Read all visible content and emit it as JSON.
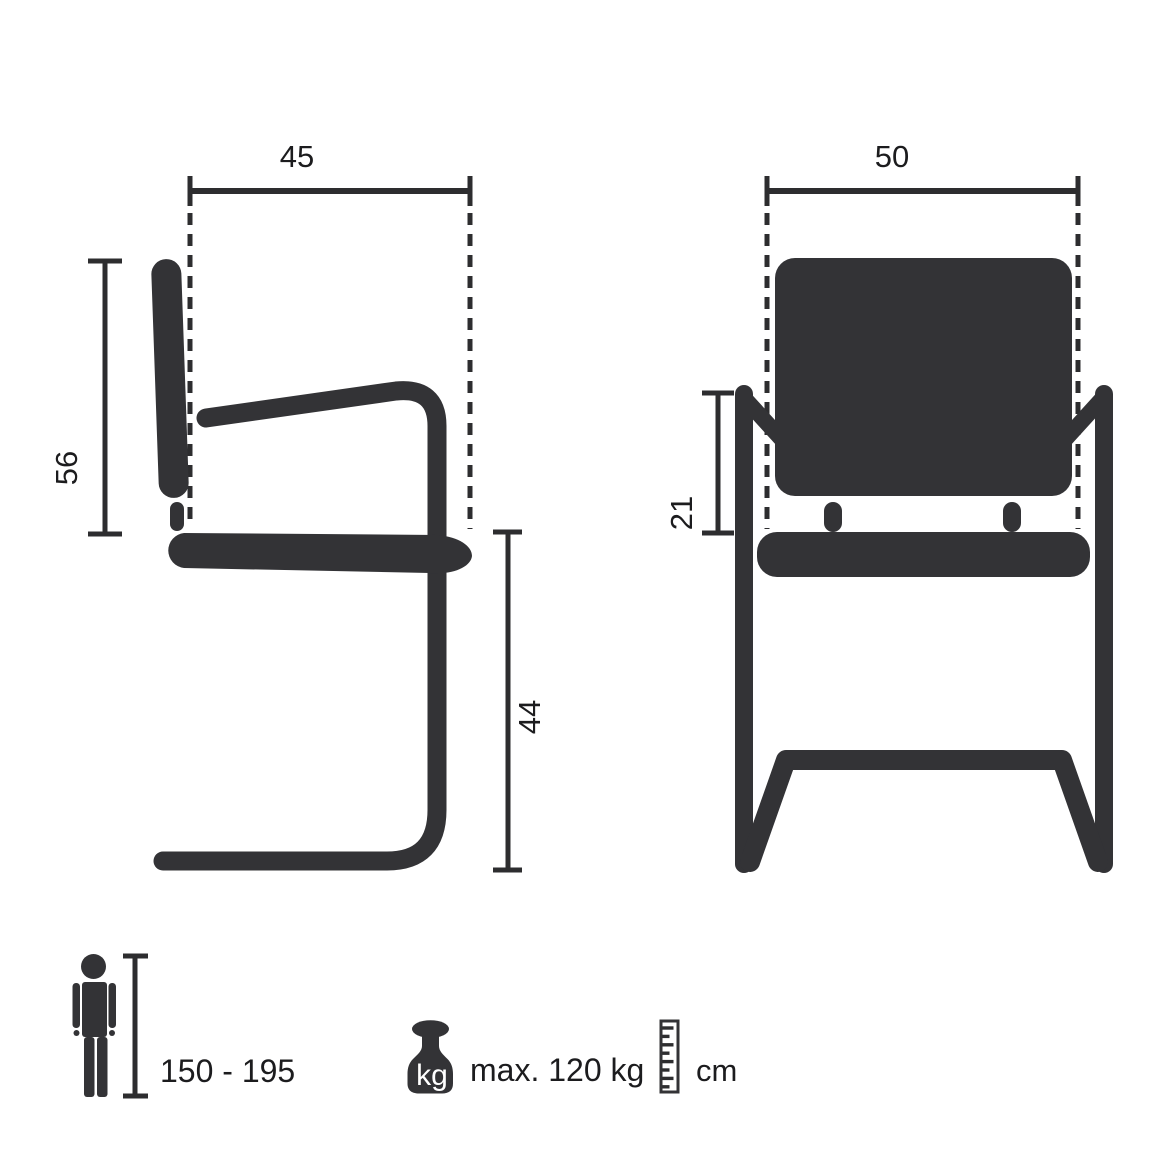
{
  "colors": {
    "bg": "#ffffff",
    "figure": "#333336",
    "line": "#2d2d2f",
    "text": "#1c1c1e",
    "icon_text": "#ffffff"
  },
  "side_view": {
    "dim_width": "45",
    "dim_backrest_height": "56",
    "dim_seat_height": "44"
  },
  "front_view": {
    "dim_width": "50",
    "dim_back_frame_height": "21"
  },
  "legend": {
    "user_height_range": "150 - 195",
    "weight_icon_label": "kg",
    "max_user_weight": "max. 120 kg",
    "measurement_unit": "cm"
  }
}
